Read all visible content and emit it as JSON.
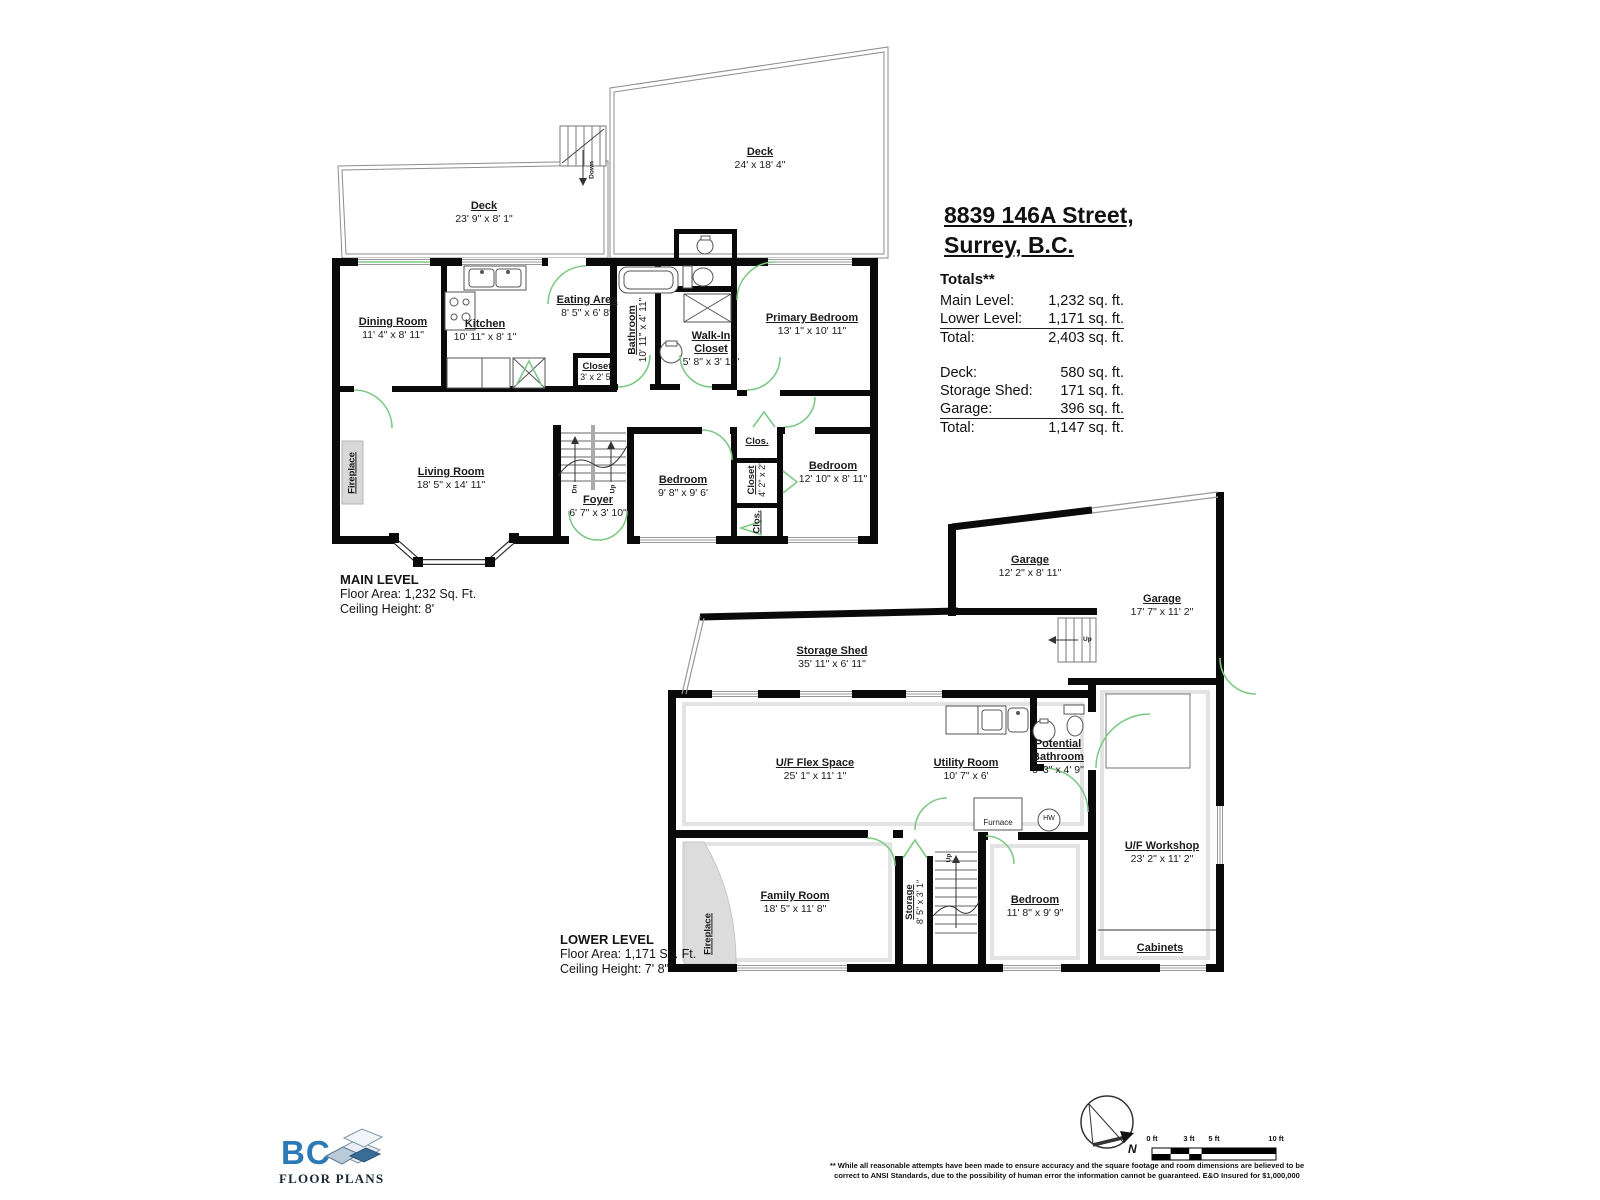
{
  "address": {
    "line1": "8839 146A Street,",
    "line2": "Surrey, B.C."
  },
  "totals": {
    "heading": "Totals**",
    "rows1": [
      {
        "label": "Main Level:",
        "value": "1,232 sq. ft."
      },
      {
        "label": "Lower Level:",
        "value": "1,171 sq. ft."
      },
      {
        "label": "Total:",
        "value": "2,403 sq. ft."
      }
    ],
    "rows2": [
      {
        "label": "Deck:",
        "value": "580 sq. ft."
      },
      {
        "label": "Storage Shed:",
        "value": "171 sq. ft."
      },
      {
        "label": "Garage:",
        "value": "396 sq. ft."
      },
      {
        "label": "Total:",
        "value": "1,147 sq. ft."
      }
    ]
  },
  "main_level": {
    "title": "MAIN LEVEL",
    "floor_area": "Floor Area: 1,232 Sq. Ft.",
    "ceiling": "Ceiling Height: 8'",
    "rooms": {
      "deck_large": {
        "name": "Deck",
        "dims": "24' x 18' 4\""
      },
      "deck_small": {
        "name": "Deck",
        "dims": "23' 9\" x 8' 1\""
      },
      "dining": {
        "name": "Dining Room",
        "dims": "11' 4\" x 8' 11\""
      },
      "kitchen": {
        "name": "Kitchen",
        "dims": "10' 11\" x 8' 1\""
      },
      "eating": {
        "name": "Eating Area",
        "dims": "8' 5\" x 6' 8\""
      },
      "closet": {
        "name": "Closet",
        "dims": "3' x 2' 5\""
      },
      "bathroom": {
        "name": "Bathroom",
        "dims": "10' 11\" x 4' 11\""
      },
      "walkin": {
        "name1": "Walk-In",
        "name2": "Closet",
        "dims": "5' 8\" x 3' 11\""
      },
      "primary": {
        "name": "Primary Bedroom",
        "dims": "13' 1\" x 10' 11\""
      },
      "living": {
        "name": "Living Room",
        "dims": "18' 5\" x 14' 11\""
      },
      "foyer": {
        "name": "Foyer",
        "dims": "6' 7\" x 3' 10\""
      },
      "bedroom2": {
        "name": "Bedroom",
        "dims": "9' 8\" x 9' 6'"
      },
      "closet_v": {
        "name": "Closet",
        "dims": "4' 2\" x 2'"
      },
      "clos_top": {
        "name": "Clos."
      },
      "clos_bottom": {
        "name": "Clos."
      },
      "bedroom3": {
        "name": "Bedroom",
        "dims": "12' 10\" x 8' 11\""
      },
      "fireplace": {
        "name": "Fireplace"
      }
    }
  },
  "lower_level": {
    "title": "LOWER LEVEL",
    "floor_area": "Floor Area: 1,171 Sq. Ft.",
    "ceiling": "Ceiling Height: 7' 8\"",
    "rooms": {
      "garage1": {
        "name": "Garage",
        "dims": "12' 2\" x 8' 11\""
      },
      "garage2": {
        "name": "Garage",
        "dims": "17' 7\" x 11' 2\""
      },
      "shed": {
        "name": "Storage Shed",
        "dims": "35' 11\" x 6' 11\""
      },
      "flex": {
        "name": "U/F Flex Space",
        "dims": "25' 1\" x 11' 1\""
      },
      "utility": {
        "name": "Utility Room",
        "dims": "10' 7\" x 6'"
      },
      "pot_bath": {
        "name1": "Potential",
        "name2": "Bathroom",
        "dims": "5' 3\" x 4' 9\""
      },
      "furnace": {
        "name": "Furnace"
      },
      "hw": {
        "name": "HW"
      },
      "family": {
        "name": "Family Room",
        "dims": "18' 5\" x 11' 8\""
      },
      "storage": {
        "name": "Storage",
        "dims": "8' 5\" x 3' 1\""
      },
      "bedroom": {
        "name": "Bedroom",
        "dims": "11' 8\" x 9' 9\""
      },
      "workshop": {
        "name": "U/F Workshop",
        "dims": "23' 2\" x 11' 2\""
      },
      "cabinets": {
        "name": "Cabinets"
      },
      "fireplace": {
        "name": "Fireplace"
      }
    }
  },
  "misc": {
    "up": "Up",
    "down": "Down",
    "dn": "Dn"
  },
  "footer": {
    "logo_bc": "BC",
    "logo_text": "FLOOR PLANS",
    "compass_n": "N",
    "scale": {
      "l0": "0 ft",
      "l3": "3 ft",
      "l5": "5 ft",
      "l10": "10 ft"
    },
    "disclaimer1": "** While all reasonable attempts have been made to ensure accuracy and the square footage and room dimensions are believed to be",
    "disclaimer2": "correct to ANSI Standards, due to the possibility of human error the information cannot be guaranteed. E&O Insured for $1,000,000"
  },
  "colors": {
    "wall": "#0a0a0a",
    "door_green": "#7fc987",
    "logo_blue": "#2b7ab8",
    "fireplace_gray": "#d9d9d9"
  }
}
